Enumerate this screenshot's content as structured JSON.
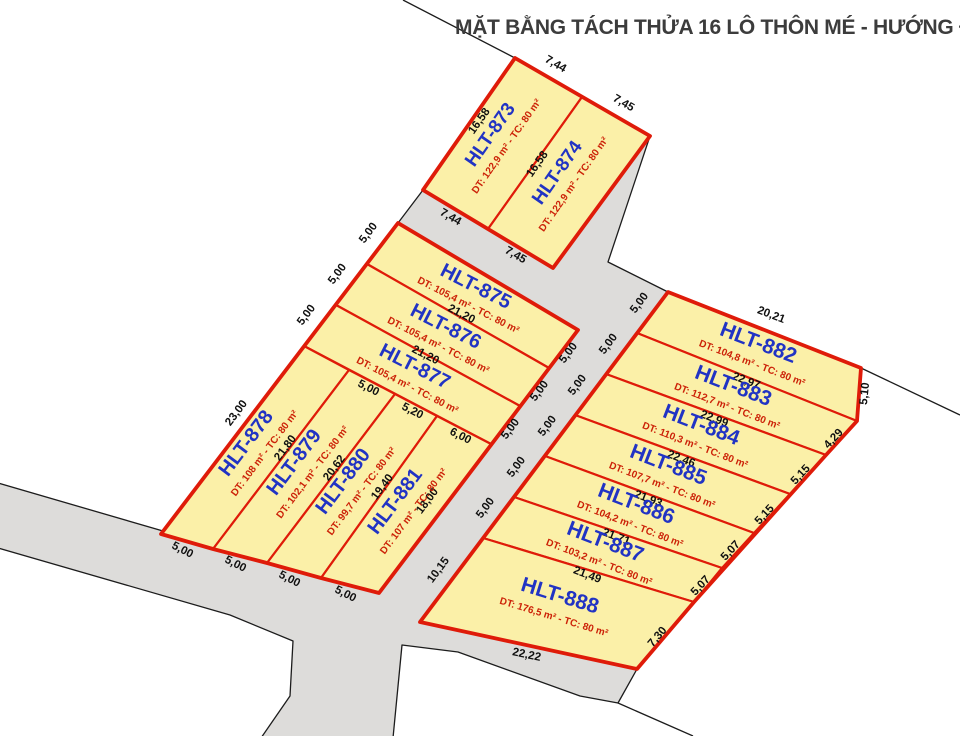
{
  "title": {
    "text": "MẶT BẰNG TÁCH THỬA 16 LÔ THÔN MÉ - HƯỚNG ĐẠO"
  },
  "colors": {
    "background": "#ffffff",
    "road_fill": "#DDDCDA",
    "road_line": "#1c1c1c",
    "parcel_fill": "#FBF0A8",
    "parcel_stroke": "#DF1B09",
    "name_text": "#2133C4",
    "dt_text": "#CC2208",
    "dim_text": "#101010",
    "title_text": "#3c3c3c"
  },
  "map": {
    "roads": [
      {
        "id": "road-network",
        "points": [
          [
            423,
            190
          ],
          [
            553,
            268
          ],
          [
            650,
            136
          ],
          [
            608,
            262
          ],
          [
            668,
            292
          ],
          [
            637,
            333
          ],
          [
            606,
            374
          ],
          [
            575,
            415
          ],
          [
            545,
            456
          ],
          [
            514,
            497
          ],
          [
            483,
            538
          ],
          [
            420,
            622
          ],
          [
            637,
            669
          ],
          [
            618,
            703
          ],
          [
            580,
            696
          ],
          [
            458,
            652
          ],
          [
            402,
            645
          ],
          [
            393,
            738
          ],
          [
            261,
            738
          ],
          [
            290,
            696
          ],
          [
            293,
            641
          ],
          [
            230,
            615
          ],
          [
            -2,
            548
          ],
          [
            -2,
            483
          ],
          [
            163,
            531
          ],
          [
            161,
            534
          ],
          [
            213,
            549
          ],
          [
            267,
            563
          ],
          [
            321,
            578
          ],
          [
            379,
            593
          ],
          [
            578,
            330
          ],
          [
            398,
            223
          ]
        ]
      }
    ],
    "boundary_lines": [
      {
        "id": "boundary-top",
        "points": [
          [
            403,
            0
          ],
          [
            515,
            58
          ]
        ]
      },
      {
        "id": "boundary-right",
        "points": [
          [
            861,
            368
          ],
          [
            960,
            415
          ]
        ]
      },
      {
        "id": "boundary-bottom",
        "points": [
          [
            618,
            703
          ],
          [
            693,
            736
          ]
        ]
      }
    ],
    "blocks": [
      {
        "id": "block-top",
        "points": [
          [
            515,
            58
          ],
          [
            650,
            136
          ],
          [
            553,
            268
          ],
          [
            423,
            190
          ]
        ]
      },
      {
        "id": "block-west",
        "points": [
          [
            398,
            223
          ],
          [
            578,
            330
          ],
          [
            379,
            593
          ],
          [
            321,
            578
          ],
          [
            267,
            563
          ],
          [
            213,
            549
          ],
          [
            161,
            534
          ]
        ]
      },
      {
        "id": "block-east",
        "points": [
          [
            668,
            292
          ],
          [
            861,
            368
          ],
          [
            857,
            421
          ],
          [
            826,
            455
          ],
          [
            694,
            602
          ],
          [
            637,
            669
          ],
          [
            420,
            622
          ]
        ]
      }
    ],
    "parcels": [
      {
        "id": "HLT-873",
        "name": "HLT-873",
        "dt": "DT: 122,9 m² - TC: 80 m²",
        "points": [
          [
            515,
            58
          ],
          [
            582,
            97
          ],
          [
            488,
            229
          ],
          [
            423,
            190
          ]
        ],
        "name_pos": {
          "x": 495,
          "y": 138,
          "r": -55,
          "fs": 19
        },
        "dt_pos": {
          "x": 509,
          "y": 148,
          "r": -55
        }
      },
      {
        "id": "HLT-874",
        "name": "HLT-874",
        "dt": "DT: 122,9 m² - TC: 80 m²",
        "points": [
          [
            582,
            97
          ],
          [
            650,
            136
          ],
          [
            553,
            268
          ],
          [
            488,
            229
          ]
        ],
        "name_pos": {
          "x": 562,
          "y": 176,
          "r": -55,
          "fs": 19
        },
        "dt_pos": {
          "x": 576,
          "y": 186,
          "r": -55
        }
      },
      {
        "id": "HLT-875",
        "name": "HLT-875",
        "dt": "DT: 105,4 m² - TC: 80 m²",
        "points": [
          [
            398,
            223
          ],
          [
            578,
            330
          ],
          [
            549,
            368
          ],
          [
            367,
            264
          ]
        ],
        "name_pos": {
          "x": 473,
          "y": 292,
          "r": 27,
          "fs": 20
        },
        "dt_pos": {
          "x": 467,
          "y": 308,
          "r": 27
        }
      },
      {
        "id": "HLT-876",
        "name": "HLT-876",
        "dt": "DT: 105,4 m² - TC: 80 m²",
        "points": [
          [
            367,
            264
          ],
          [
            549,
            368
          ],
          [
            520,
            406
          ],
          [
            336,
            305
          ]
        ],
        "name_pos": {
          "x": 443,
          "y": 332,
          "r": 27,
          "fs": 20
        },
        "dt_pos": {
          "x": 437,
          "y": 348,
          "r": 27
        }
      },
      {
        "id": "HLT-877",
        "name": "HLT-877",
        "dt": "DT: 105,4 m² - TC: 80 m²",
        "points": [
          [
            336,
            305
          ],
          [
            520,
            406
          ],
          [
            491,
            444
          ],
          [
            304,
            346
          ]
        ],
        "name_pos": {
          "x": 412,
          "y": 372,
          "r": 27,
          "fs": 20
        },
        "dt_pos": {
          "x": 406,
          "y": 388,
          "r": 27
        }
      },
      {
        "id": "HLT-878",
        "name": "HLT-878",
        "dt": "DT: 108 m² - TC: 80 m²",
        "points": [
          [
            304,
            346
          ],
          [
            349,
            370
          ],
          [
            213,
            549
          ],
          [
            161,
            534
          ]
        ],
        "name_pos": {
          "x": 251,
          "y": 447,
          "r": -53,
          "fs": 20
        },
        "dt_pos": {
          "x": 267,
          "y": 455,
          "r": -53
        }
      },
      {
        "id": "HLT-879",
        "name": "HLT-879",
        "dt": "DT: 102,1 m² - TC: 80 m²",
        "points": [
          [
            349,
            370
          ],
          [
            395,
            394
          ],
          [
            267,
            563
          ],
          [
            213,
            549
          ]
        ],
        "name_pos": {
          "x": 299,
          "y": 466,
          "r": -53,
          "fs": 20
        },
        "dt_pos": {
          "x": 315,
          "y": 474,
          "r": -53
        }
      },
      {
        "id": "HLT-880",
        "name": "HLT-880",
        "dt": "DT: 99,7 m² - TC: 80 m²",
        "points": [
          [
            395,
            394
          ],
          [
            437,
            416
          ],
          [
            321,
            578
          ],
          [
            267,
            563
          ]
        ],
        "name_pos": {
          "x": 348,
          "y": 485,
          "r": -53,
          "fs": 20
        },
        "dt_pos": {
          "x": 364,
          "y": 493,
          "r": -53
        }
      },
      {
        "id": "HLT-881",
        "name": "HLT-881",
        "dt": "DT: 107 m² - TC: 80 m²",
        "points": [
          [
            437,
            416
          ],
          [
            491,
            444
          ],
          [
            379,
            593
          ],
          [
            321,
            578
          ]
        ],
        "name_pos": {
          "x": 400,
          "y": 505,
          "r": -53,
          "fs": 20
        },
        "dt_pos": {
          "x": 416,
          "y": 513,
          "r": -53
        }
      },
      {
        "id": "HLT-882",
        "name": "HLT-882",
        "dt": "DT: 104,8 m² - TC: 80 m²",
        "points": [
          [
            668,
            292
          ],
          [
            861,
            368
          ],
          [
            857,
            421
          ],
          [
            637,
            333
          ]
        ],
        "name_pos": {
          "x": 756,
          "y": 349,
          "r": 21,
          "fs": 21
        },
        "dt_pos": {
          "x": 751,
          "y": 366,
          "r": 21
        }
      },
      {
        "id": "HLT-883",
        "name": "HLT-883",
        "dt": "DT: 112,7 m² - TC: 80 m²",
        "points": [
          [
            637,
            333
          ],
          [
            857,
            421
          ],
          [
            826,
            455
          ],
          [
            606,
            374
          ]
        ],
        "name_pos": {
          "x": 731,
          "y": 392,
          "r": 21,
          "fs": 21
        },
        "dt_pos": {
          "x": 726,
          "y": 409,
          "r": 21
        }
      },
      {
        "id": "HLT-884",
        "name": "HLT-884",
        "dt": "DT: 110,3 m² - TC: 80 m²",
        "points": [
          [
            606,
            374
          ],
          [
            826,
            455
          ],
          [
            790,
            494
          ],
          [
            575,
            415
          ]
        ],
        "name_pos": {
          "x": 699,
          "y": 431,
          "r": 21,
          "fs": 21
        },
        "dt_pos": {
          "x": 694,
          "y": 448,
          "r": 21
        }
      },
      {
        "id": "HLT-885",
        "name": "HLT-885",
        "dt": "DT: 107,7 m² - TC: 80 m²",
        "points": [
          [
            575,
            415
          ],
          [
            790,
            494
          ],
          [
            754,
            533
          ],
          [
            545,
            456
          ]
        ],
        "name_pos": {
          "x": 666,
          "y": 471,
          "r": 21,
          "fs": 21
        },
        "dt_pos": {
          "x": 661,
          "y": 488,
          "r": 21
        }
      },
      {
        "id": "HLT-886",
        "name": "HLT-886",
        "dt": "DT: 104,2 m² - TC: 80 m²",
        "points": [
          [
            545,
            456
          ],
          [
            754,
            533
          ],
          [
            722,
            568
          ],
          [
            514,
            497
          ]
        ],
        "name_pos": {
          "x": 634,
          "y": 510,
          "r": 21,
          "fs": 21
        },
        "dt_pos": {
          "x": 629,
          "y": 527,
          "r": 21
        }
      },
      {
        "id": "HLT-887",
        "name": "HLT-887",
        "dt": "DT: 103,2 m² - TC: 80 m²",
        "points": [
          [
            514,
            497
          ],
          [
            722,
            568
          ],
          [
            694,
            602
          ],
          [
            483,
            538
          ]
        ],
        "name_pos": {
          "x": 603,
          "y": 548,
          "r": 21,
          "fs": 21
        },
        "dt_pos": {
          "x": 598,
          "y": 565,
          "r": 21
        }
      },
      {
        "id": "HLT-888",
        "name": "HLT-888",
        "dt": "DT: 176,5 m² - TC: 80 m²",
        "points": [
          [
            483,
            538
          ],
          [
            694,
            602
          ],
          [
            637,
            669
          ],
          [
            420,
            622
          ]
        ],
        "name_pos": {
          "x": 558,
          "y": 602,
          "r": 17,
          "fs": 21
        },
        "dt_pos": {
          "x": 553,
          "y": 620,
          "r": 17
        }
      }
    ],
    "dims": [
      {
        "t": "7,44",
        "x": 554,
        "y": 67,
        "r": 30
      },
      {
        "t": "7,45",
        "x": 622,
        "y": 106,
        "r": 30
      },
      {
        "t": "16,58",
        "x": 482,
        "y": 123,
        "r": -55
      },
      {
        "t": "16,58",
        "x": 540,
        "y": 166,
        "r": -55
      },
      {
        "t": "7,44",
        "x": 449,
        "y": 220,
        "r": 30
      },
      {
        "t": "7,45",
        "x": 514,
        "y": 258,
        "r": 30
      },
      {
        "t": "5,00",
        "x": 371,
        "y": 235,
        "r": -53
      },
      {
        "t": "5,00",
        "x": 340,
        "y": 276,
        "r": -53
      },
      {
        "t": "5,00",
        "x": 309,
        "y": 317,
        "r": -53
      },
      {
        "t": "23,00",
        "x": 239,
        "y": 415,
        "r": -53
      },
      {
        "t": "21,20",
        "x": 460,
        "y": 317,
        "r": 27
      },
      {
        "t": "21,20",
        "x": 424,
        "y": 358,
        "r": 27
      },
      {
        "t": "5,00",
        "x": 367,
        "y": 391,
        "r": 27
      },
      {
        "t": "5,20",
        "x": 411,
        "y": 414,
        "r": 27
      },
      {
        "t": "6,00",
        "x": 459,
        "y": 439,
        "r": 27
      },
      {
        "t": "21,80",
        "x": 288,
        "y": 450,
        "r": -53
      },
      {
        "t": "20,62",
        "x": 337,
        "y": 470,
        "r": -53
      },
      {
        "t": "19,40",
        "x": 385,
        "y": 489,
        "r": -53
      },
      {
        "t": "18,00",
        "x": 430,
        "y": 503,
        "r": -53
      },
      {
        "t": "5,00",
        "x": 181,
        "y": 553,
        "r": 27
      },
      {
        "t": "5,00",
        "x": 234,
        "y": 567,
        "r": 27
      },
      {
        "t": "5,00",
        "x": 288,
        "y": 582,
        "r": 27
      },
      {
        "t": "5,00",
        "x": 344,
        "y": 597,
        "r": 27
      },
      {
        "t": "5,00",
        "x": 571,
        "y": 355,
        "r": -53
      },
      {
        "t": "5,00",
        "x": 542,
        "y": 393,
        "r": -53
      },
      {
        "t": "5,00",
        "x": 513,
        "y": 431,
        "r": -53
      },
      {
        "t": "20,21",
        "x": 770,
        "y": 318,
        "r": 21
      },
      {
        "t": "5,10",
        "x": 868,
        "y": 394,
        "r": -84
      },
      {
        "t": "4,29",
        "x": 836,
        "y": 441,
        "r": -47
      },
      {
        "t": "5,15",
        "x": 803,
        "y": 477,
        "r": -47
      },
      {
        "t": "5,15",
        "x": 767,
        "y": 517,
        "r": -47
      },
      {
        "t": "5,07",
        "x": 733,
        "y": 553,
        "r": -47
      },
      {
        "t": "5,07",
        "x": 703,
        "y": 588,
        "r": -47
      },
      {
        "t": "7,30",
        "x": 660,
        "y": 639,
        "r": -50
      },
      {
        "t": "22,97",
        "x": 745,
        "y": 384,
        "r": 21
      },
      {
        "t": "22,99",
        "x": 713,
        "y": 422,
        "r": 21
      },
      {
        "t": "22,46",
        "x": 680,
        "y": 462,
        "r": 21
      },
      {
        "t": "21,93",
        "x": 647,
        "y": 502,
        "r": 21
      },
      {
        "t": "21,71",
        "x": 615,
        "y": 540,
        "r": 21
      },
      {
        "t": "21,49",
        "x": 586,
        "y": 578,
        "r": 21
      },
      {
        "t": "22,22",
        "x": 526,
        "y": 658,
        "r": 12
      },
      {
        "t": "5,00",
        "x": 642,
        "y": 305,
        "r": -53
      },
      {
        "t": "5,00",
        "x": 611,
        "y": 346,
        "r": -53
      },
      {
        "t": "5,00",
        "x": 580,
        "y": 387,
        "r": -53
      },
      {
        "t": "5,00",
        "x": 550,
        "y": 428,
        "r": -53
      },
      {
        "t": "5,00",
        "x": 519,
        "y": 469,
        "r": -53
      },
      {
        "t": "5,00",
        "x": 488,
        "y": 510,
        "r": -53
      },
      {
        "t": "10,15",
        "x": 441,
        "y": 572,
        "r": -53
      }
    ]
  }
}
